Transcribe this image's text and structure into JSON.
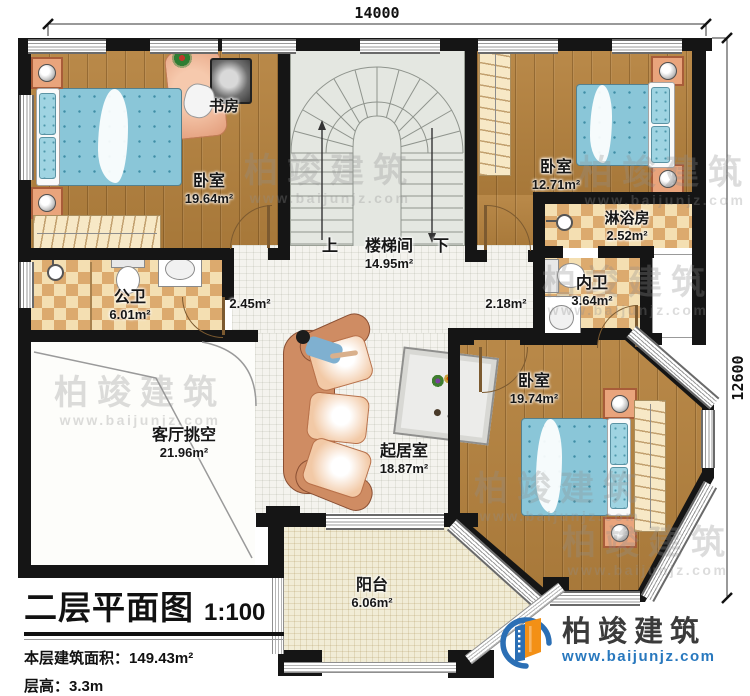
{
  "dimensions": {
    "top": "14000",
    "right": "12600"
  },
  "title_block": {
    "title": "二层平面图",
    "scale": "1:100",
    "area_label": "本层建筑面积：",
    "area_value": "149.43m²",
    "height_label": "层高：",
    "height_value": "3.3m"
  },
  "brand": {
    "name": "柏竣建筑",
    "website": "www.baijunjz.com"
  },
  "watermark": {
    "name": "柏竣建筑",
    "website": "www.baijunjz.com"
  },
  "stair": {
    "up": "上",
    "down": "下"
  },
  "rooms": [
    {
      "id": "bedroom-nw",
      "name": "卧室",
      "area": "19.64m²"
    },
    {
      "id": "study",
      "name": "书房",
      "area": ""
    },
    {
      "id": "stairwell",
      "name": "楼梯间",
      "area": "14.95m²"
    },
    {
      "id": "bedroom-ne",
      "name": "卧室",
      "area": "12.71m²"
    },
    {
      "id": "shower-room",
      "name": "淋浴房",
      "area": "2.52m²"
    },
    {
      "id": "ensuite-bath",
      "name": "内卫",
      "area": "3.64m²"
    },
    {
      "id": "hallway-left",
      "name": "",
      "area": "2.45m²"
    },
    {
      "id": "hallway-right",
      "name": "",
      "area": "2.18m²"
    },
    {
      "id": "public-bath",
      "name": "公卫",
      "area": "6.01m²"
    },
    {
      "id": "living-void",
      "name": "客厅挑空",
      "area": "21.96m²"
    },
    {
      "id": "family-room",
      "name": "起居室",
      "area": "18.87m²"
    },
    {
      "id": "bedroom-se",
      "name": "卧室",
      "area": "19.74m²"
    },
    {
      "id": "balcony",
      "name": "阳台",
      "area": "6.06m²"
    }
  ],
  "colors": {
    "wall": "#151515",
    "wood_floor": "#b5823e",
    "tile_light": "#f4dfb2",
    "tile_dark": "#dcaa6e",
    "bed_blue": "#8ac6d8",
    "sofa_salmon": "#cf8c63",
    "brand_blue": "#2b6fb5",
    "brand_orange": "#f39016",
    "watermark_gray": "#8f8f8f"
  }
}
